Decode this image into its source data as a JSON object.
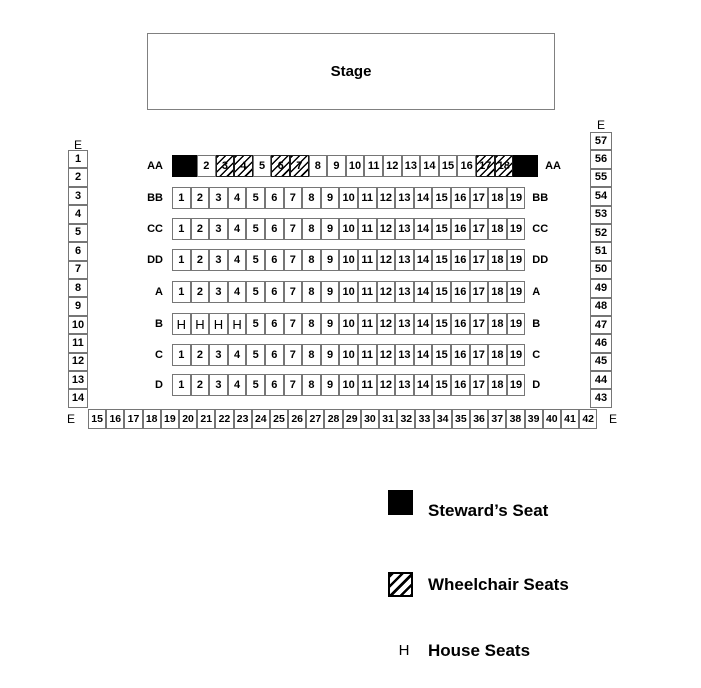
{
  "stage": {
    "label": "Stage"
  },
  "seating": {
    "left_column": {
      "label": "E",
      "seats": [
        "1",
        "2",
        "3",
        "4",
        "5",
        "6",
        "7",
        "8",
        "9",
        "10",
        "11",
        "12",
        "13",
        "14"
      ]
    },
    "right_column": {
      "label": "E",
      "seats": [
        "57",
        "56",
        "55",
        "54",
        "53",
        "52",
        "51",
        "50",
        "49",
        "48",
        "47",
        "46",
        "45",
        "44",
        "43"
      ]
    },
    "bottom_row": {
      "label": "E",
      "seats": [
        "15",
        "16",
        "17",
        "18",
        "19",
        "20",
        "21",
        "22",
        "23",
        "24",
        "25",
        "26",
        "27",
        "28",
        "29",
        "30",
        "31",
        "32",
        "33",
        "34",
        "35",
        "36",
        "37",
        "38",
        "39",
        "40",
        "41",
        "42"
      ]
    },
    "rows": [
      {
        "label": "AA",
        "seats": [
          {
            "n": "1",
            "t": "steward",
            "display": ""
          },
          {
            "n": "2",
            "t": "normal"
          },
          {
            "n": "3",
            "t": "wheelchair"
          },
          {
            "n": "4",
            "t": "wheelchair"
          },
          {
            "n": "5",
            "t": "normal"
          },
          {
            "n": "6",
            "t": "wheelchair"
          },
          {
            "n": "7",
            "t": "wheelchair"
          },
          {
            "n": "8",
            "t": "normal"
          },
          {
            "n": "9",
            "t": "normal"
          },
          {
            "n": "10",
            "t": "normal"
          },
          {
            "n": "11",
            "t": "normal"
          },
          {
            "n": "12",
            "t": "normal"
          },
          {
            "n": "13",
            "t": "normal"
          },
          {
            "n": "14",
            "t": "normal"
          },
          {
            "n": "15",
            "t": "normal"
          },
          {
            "n": "16",
            "t": "normal"
          },
          {
            "n": "17",
            "t": "wheelchair"
          },
          {
            "n": "18",
            "t": "wheelchair"
          },
          {
            "n": "19",
            "t": "steward",
            "display": ""
          }
        ]
      },
      {
        "label": "BB",
        "seats": [
          {
            "n": "1",
            "t": "normal"
          },
          {
            "n": "2",
            "t": "normal"
          },
          {
            "n": "3",
            "t": "normal"
          },
          {
            "n": "4",
            "t": "normal"
          },
          {
            "n": "5",
            "t": "normal"
          },
          {
            "n": "6",
            "t": "normal"
          },
          {
            "n": "7",
            "t": "normal"
          },
          {
            "n": "8",
            "t": "normal"
          },
          {
            "n": "9",
            "t": "normal"
          },
          {
            "n": "10",
            "t": "normal"
          },
          {
            "n": "11",
            "t": "normal"
          },
          {
            "n": "12",
            "t": "normal"
          },
          {
            "n": "13",
            "t": "normal"
          },
          {
            "n": "14",
            "t": "normal"
          },
          {
            "n": "15",
            "t": "normal"
          },
          {
            "n": "16",
            "t": "normal"
          },
          {
            "n": "17",
            "t": "normal"
          },
          {
            "n": "18",
            "t": "normal"
          },
          {
            "n": "19",
            "t": "normal"
          }
        ]
      },
      {
        "label": "CC",
        "seats": [
          {
            "n": "1",
            "t": "normal"
          },
          {
            "n": "2",
            "t": "normal"
          },
          {
            "n": "3",
            "t": "normal"
          },
          {
            "n": "4",
            "t": "normal"
          },
          {
            "n": "5",
            "t": "normal"
          },
          {
            "n": "6",
            "t": "normal"
          },
          {
            "n": "7",
            "t": "normal"
          },
          {
            "n": "8",
            "t": "normal"
          },
          {
            "n": "9",
            "t": "normal"
          },
          {
            "n": "10",
            "t": "normal"
          },
          {
            "n": "11",
            "t": "normal"
          },
          {
            "n": "12",
            "t": "normal"
          },
          {
            "n": "13",
            "t": "normal"
          },
          {
            "n": "14",
            "t": "normal"
          },
          {
            "n": "15",
            "t": "normal"
          },
          {
            "n": "16",
            "t": "normal"
          },
          {
            "n": "17",
            "t": "normal"
          },
          {
            "n": "18",
            "t": "normal"
          },
          {
            "n": "19",
            "t": "normal"
          }
        ]
      },
      {
        "label": "DD",
        "seats": [
          {
            "n": "1",
            "t": "normal"
          },
          {
            "n": "2",
            "t": "normal"
          },
          {
            "n": "3",
            "t": "normal"
          },
          {
            "n": "4",
            "t": "normal"
          },
          {
            "n": "5",
            "t": "normal"
          },
          {
            "n": "6",
            "t": "normal"
          },
          {
            "n": "7",
            "t": "normal"
          },
          {
            "n": "8",
            "t": "normal"
          },
          {
            "n": "9",
            "t": "normal"
          },
          {
            "n": "10",
            "t": "normal"
          },
          {
            "n": "11",
            "t": "normal"
          },
          {
            "n": "12",
            "t": "normal"
          },
          {
            "n": "13",
            "t": "normal"
          },
          {
            "n": "14",
            "t": "normal"
          },
          {
            "n": "15",
            "t": "normal"
          },
          {
            "n": "16",
            "t": "normal"
          },
          {
            "n": "17",
            "t": "normal"
          },
          {
            "n": "18",
            "t": "normal"
          },
          {
            "n": "19",
            "t": "normal"
          }
        ]
      },
      {
        "label": "A",
        "seats": [
          {
            "n": "1",
            "t": "normal"
          },
          {
            "n": "2",
            "t": "normal"
          },
          {
            "n": "3",
            "t": "normal"
          },
          {
            "n": "4",
            "t": "normal"
          },
          {
            "n": "5",
            "t": "normal"
          },
          {
            "n": "6",
            "t": "normal"
          },
          {
            "n": "7",
            "t": "normal"
          },
          {
            "n": "8",
            "t": "normal"
          },
          {
            "n": "9",
            "t": "normal"
          },
          {
            "n": "10",
            "t": "normal"
          },
          {
            "n": "11",
            "t": "normal"
          },
          {
            "n": "12",
            "t": "normal"
          },
          {
            "n": "13",
            "t": "normal"
          },
          {
            "n": "14",
            "t": "normal"
          },
          {
            "n": "15",
            "t": "normal"
          },
          {
            "n": "16",
            "t": "normal"
          },
          {
            "n": "17",
            "t": "normal"
          },
          {
            "n": "18",
            "t": "normal"
          },
          {
            "n": "19",
            "t": "normal"
          }
        ]
      },
      {
        "label": "B",
        "seats": [
          {
            "n": "1",
            "t": "house",
            "display": "H"
          },
          {
            "n": "2",
            "t": "house",
            "display": "H"
          },
          {
            "n": "3",
            "t": "house",
            "display": "H"
          },
          {
            "n": "4",
            "t": "house",
            "display": "H"
          },
          {
            "n": "5",
            "t": "normal"
          },
          {
            "n": "6",
            "t": "normal"
          },
          {
            "n": "7",
            "t": "normal"
          },
          {
            "n": "8",
            "t": "normal"
          },
          {
            "n": "9",
            "t": "normal"
          },
          {
            "n": "10",
            "t": "normal"
          },
          {
            "n": "11",
            "t": "normal"
          },
          {
            "n": "12",
            "t": "normal"
          },
          {
            "n": "13",
            "t": "normal"
          },
          {
            "n": "14",
            "t": "normal"
          },
          {
            "n": "15",
            "t": "normal"
          },
          {
            "n": "16",
            "t": "normal"
          },
          {
            "n": "17",
            "t": "normal"
          },
          {
            "n": "18",
            "t": "normal"
          },
          {
            "n": "19",
            "t": "normal"
          }
        ]
      },
      {
        "label": "C",
        "seats": [
          {
            "n": "1",
            "t": "normal"
          },
          {
            "n": "2",
            "t": "normal"
          },
          {
            "n": "3",
            "t": "normal"
          },
          {
            "n": "4",
            "t": "normal"
          },
          {
            "n": "5",
            "t": "normal"
          },
          {
            "n": "6",
            "t": "normal"
          },
          {
            "n": "7",
            "t": "normal"
          },
          {
            "n": "8",
            "t": "normal"
          },
          {
            "n": "9",
            "t": "normal"
          },
          {
            "n": "10",
            "t": "normal"
          },
          {
            "n": "11",
            "t": "normal"
          },
          {
            "n": "12",
            "t": "normal"
          },
          {
            "n": "13",
            "t": "normal"
          },
          {
            "n": "14",
            "t": "normal"
          },
          {
            "n": "15",
            "t": "normal"
          },
          {
            "n": "16",
            "t": "normal"
          },
          {
            "n": "17",
            "t": "normal"
          },
          {
            "n": "18",
            "t": "normal"
          },
          {
            "n": "19",
            "t": "normal"
          }
        ]
      },
      {
        "label": "D",
        "seats": [
          {
            "n": "1",
            "t": "normal"
          },
          {
            "n": "2",
            "t": "normal"
          },
          {
            "n": "3",
            "t": "normal"
          },
          {
            "n": "4",
            "t": "normal"
          },
          {
            "n": "5",
            "t": "normal"
          },
          {
            "n": "6",
            "t": "normal"
          },
          {
            "n": "7",
            "t": "normal"
          },
          {
            "n": "8",
            "t": "normal"
          },
          {
            "n": "9",
            "t": "normal"
          },
          {
            "n": "10",
            "t": "normal"
          },
          {
            "n": "11",
            "t": "normal"
          },
          {
            "n": "12",
            "t": "normal"
          },
          {
            "n": "13",
            "t": "normal"
          },
          {
            "n": "14",
            "t": "normal"
          },
          {
            "n": "15",
            "t": "normal"
          },
          {
            "n": "16",
            "t": "normal"
          },
          {
            "n": "17",
            "t": "normal"
          },
          {
            "n": "18",
            "t": "normal"
          },
          {
            "n": "19",
            "t": "normal"
          }
        ]
      }
    ]
  },
  "legend": {
    "items": [
      {
        "name": "steward",
        "label": "Steward’s Seat",
        "swatch": "black-square"
      },
      {
        "name": "wheelchair",
        "label": "Wheelchair Seats",
        "swatch": "hatched-square"
      },
      {
        "name": "house",
        "label": "House Seats",
        "symbol": "H"
      }
    ]
  },
  "colors": {
    "seat_border": "#767676",
    "steward_fill": "#000000",
    "text": "#000000",
    "background": "#ffffff"
  }
}
